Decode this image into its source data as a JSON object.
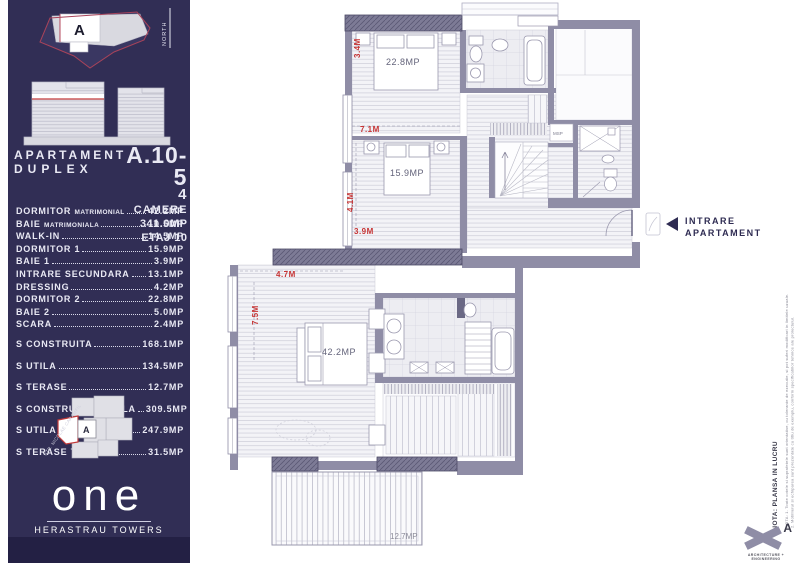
{
  "sidebar": {
    "site": {
      "a": "A",
      "north": "NORTH"
    },
    "title": {
      "apartament": "APARTAMENT",
      "duplex": "DUPLEX",
      "code": "A.10-5",
      "rooms_num": "4",
      "rooms_word": "CAMERE",
      "area": "341.0MP",
      "floor": "ETAJ 10"
    },
    "room_list": [
      {
        "label": "DORMITOR",
        "sub": "MATRIMONIAL",
        "value": "42.2MP"
      },
      {
        "label": "BAIE",
        "sub": "MATRIMONIALA",
        "value": "10.5MP"
      },
      {
        "label": "WALK-IN",
        "value": "14.5MP"
      },
      {
        "label": "DORMITOR 1",
        "value": "15.9MP"
      },
      {
        "label": "BAIE 1",
        "value": "3.9MP"
      },
      {
        "label": "INTRARE SECUNDARA",
        "value": "13.1MP"
      },
      {
        "label": "DRESSING",
        "value": "4.2MP"
      },
      {
        "label": "DORMITOR 2",
        "value": "22.8MP"
      },
      {
        "label": "BAIE 2",
        "value": "5.0MP"
      },
      {
        "label": "SCARA",
        "value": "2.4MP"
      }
    ],
    "totals": [
      {
        "label": "S CONSTRUITA",
        "value": "168.1MP"
      },
      {
        "label": "S UTILA",
        "value": "134.5MP"
      },
      {
        "label": "S TERASE",
        "value": "12.7MP"
      },
      {
        "label": "S CONSTRUITA TOTALA",
        "value": "309.5MP"
      },
      {
        "label": "S UTILA TOTALA",
        "value": "247.9MP"
      },
      {
        "label": "S TERASE TOTALA",
        "value": "31.5MP"
      }
    ],
    "map": {
      "a": "A",
      "street": "STR. NICOLAE CARAMFIL"
    },
    "logo": {
      "brand": "one",
      "sub": "HERASTRAU TOWERS"
    }
  },
  "plan": {
    "rooms": {
      "d2": "22.8MP",
      "d1": "15.9MP",
      "master": "42.2MP",
      "terrace": "12.7MP",
      "msp": "MSP"
    },
    "dims": {
      "a": "3.4M",
      "b": "7.1M",
      "c": "4.1M",
      "d": "3.9M",
      "e": "4.7M",
      "f": "7.5M"
    },
    "entrance": {
      "l1": "INTRARE",
      "l2": "APARTAMENT"
    }
  },
  "notes": {
    "status": "NOTA: PLANSA IN LUCRU",
    "fine1": "NOTA: 1. Toate cotele si suprafetele sunt orientative, cu tolerante de executie, si pot suferi modificari in limitele uzuale.",
    "fine2": "2. Mobilierul si echiparea sunt prezentate cu titlu de exemplu, conform specificatiilor tehnice ale proiectului.",
    "firm": "ARCHITECTURE + ENGINEERING",
    "mark": "A"
  },
  "colors": {
    "navy": "#312e55",
    "navy_dark": "#232044",
    "red": "#c63434",
    "wall": "#8f8da6",
    "wall_dark": "#6b6985"
  }
}
